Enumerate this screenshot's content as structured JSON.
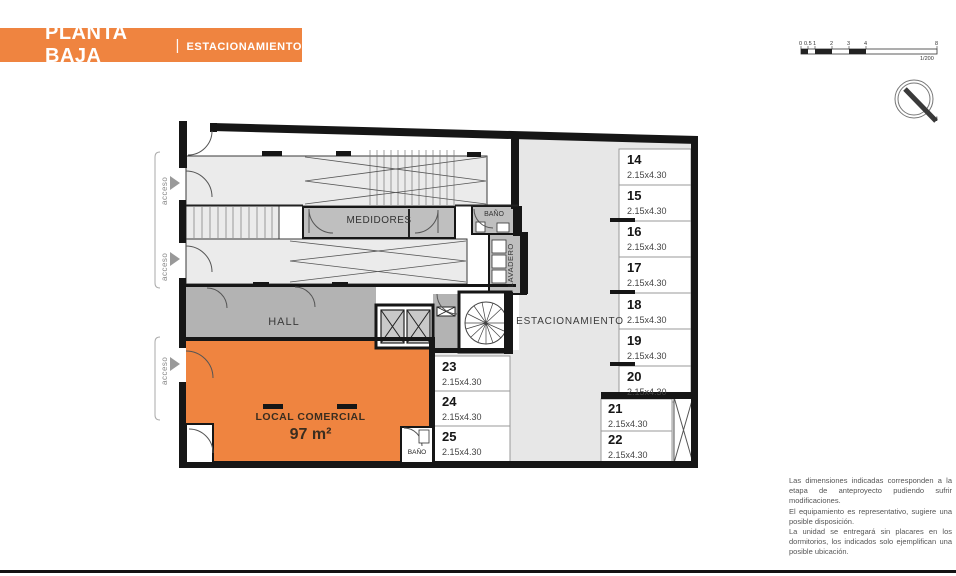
{
  "header": {
    "title": "PLANTA BAJA",
    "separator": "|",
    "subtitle": "ESTACIONAMIENTO"
  },
  "scalebar": {
    "ticks": [
      "0",
      "0.5",
      "1",
      "2",
      "3",
      "4",
      "8"
    ],
    "ratio_label": "1/200"
  },
  "compass": {
    "north_label": "N"
  },
  "plan": {
    "access": {
      "a1": "acceso",
      "a2": "acceso",
      "a3": "acceso"
    },
    "rooms": {
      "medidores": "MEDIDORES",
      "banio_top": "BAÑO",
      "lavadero": "LAVADERO",
      "hall": "HALL",
      "estacionamiento": "ESTACIONAMIENTO",
      "local_name": "LOCAL COMERCIAL",
      "local_area": "97 m²",
      "banio_local": "BAÑO"
    },
    "stalls": [
      {
        "num": "14",
        "dim": "2.15x4.30"
      },
      {
        "num": "15",
        "dim": "2.15x4.30"
      },
      {
        "num": "16",
        "dim": "2.15x4.30"
      },
      {
        "num": "17",
        "dim": "2.15x4.30"
      },
      {
        "num": "18",
        "dim": "2.15x4.30"
      },
      {
        "num": "19",
        "dim": "2.15x4.30"
      },
      {
        "num": "20",
        "dim": "2.15x4.30"
      },
      {
        "num": "21",
        "dim": "2.15x4.30"
      },
      {
        "num": "22",
        "dim": "2.15x4.30"
      },
      {
        "num": "23",
        "dim": "2.15x4.30"
      },
      {
        "num": "24",
        "dim": "2.15x4.30"
      },
      {
        "num": "25",
        "dim": "2.15x4.30"
      }
    ]
  },
  "colors": {
    "accent_orange": "#EF8440",
    "wall_black": "#161616",
    "parking_gray": "#e7e7e7",
    "room_gray": "#bfbfbf",
    "hall_gray": "#b3b3b3"
  },
  "disclaimer": {
    "p1": "Las dimensiones indicadas corresponden a la etapa de anteproyecto pudiendo sufrir modificaciones.",
    "p2": "El equipamiento es representativo, sugiere una posible disposición.",
    "p3": "La unidad se entregará sin placares en los dormitorios, los indicados solo ejemplifican una posible ubicación."
  }
}
